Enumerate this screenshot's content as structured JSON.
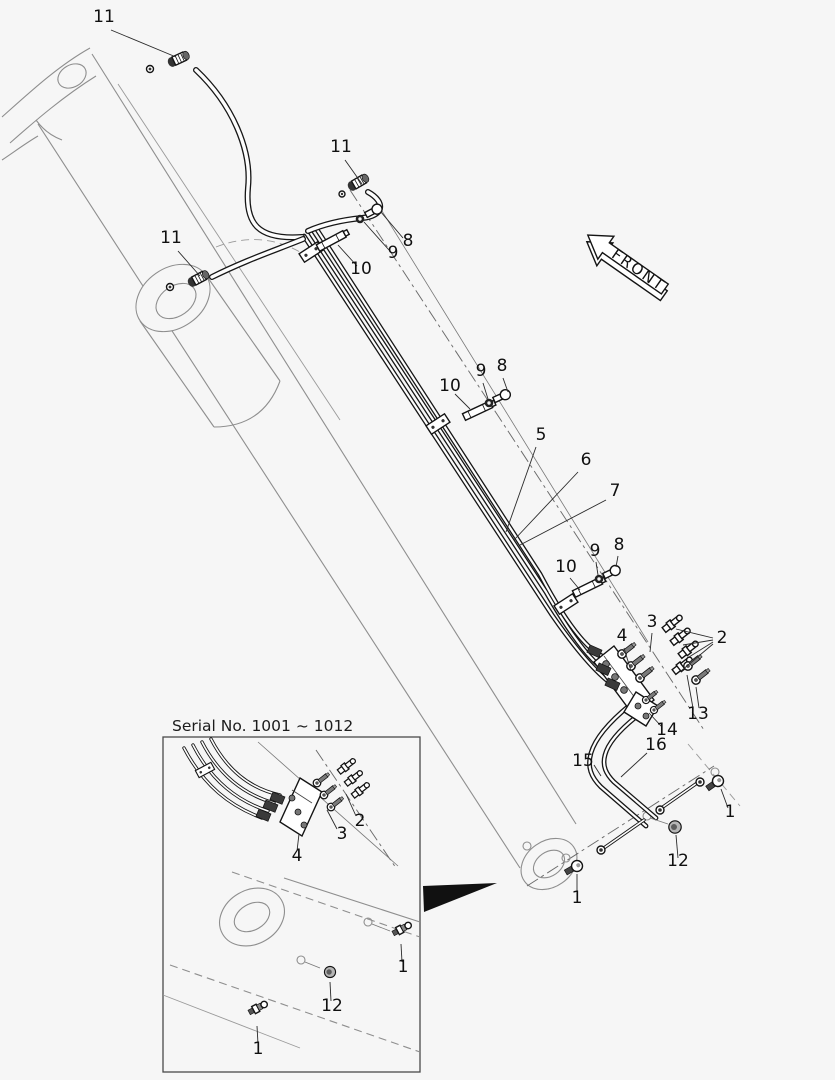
{
  "diagram_kind": "exploded-parts-piping-diagram",
  "colors": {
    "background": "#f6f6f6",
    "line": "#161616",
    "structure": "#8e8e8e",
    "callout_text": "#101010"
  },
  "front_arrow": {
    "label": "FRONT"
  },
  "inset": {
    "title": "Serial No. 1001 ~ 1012"
  },
  "callouts": [
    {
      "view": "main",
      "label": "11",
      "x": 104,
      "y": 22,
      "leaders": [
        [
          111,
          30,
          176,
          57
        ]
      ]
    },
    {
      "view": "main",
      "label": "11",
      "x": 341,
      "y": 152,
      "leaders": [
        [
          345,
          160,
          362,
          184
        ]
      ]
    },
    {
      "view": "main",
      "label": "11",
      "x": 171,
      "y": 243,
      "leaders": [
        [
          178,
          251,
          200,
          276
        ]
      ]
    },
    {
      "view": "main",
      "label": "8",
      "x": 408,
      "y": 246,
      "leaders": [
        [
          403,
          238,
          381,
          212
        ]
      ]
    },
    {
      "view": "main",
      "label": "9",
      "x": 393,
      "y": 258,
      "leaders": [
        [
          389,
          250,
          364,
          222
        ]
      ]
    },
    {
      "view": "main",
      "label": "10",
      "x": 361,
      "y": 274,
      "leaders": [
        [
          357,
          266,
          338,
          245
        ]
      ]
    },
    {
      "view": "main",
      "label": "10",
      "x": 450,
      "y": 391,
      "leaders": [
        [
          455,
          394,
          470,
          409
        ]
      ]
    },
    {
      "view": "main",
      "label": "9",
      "x": 481,
      "y": 376,
      "leaders": [
        [
          483,
          383,
          488,
          399
        ]
      ]
    },
    {
      "view": "main",
      "label": "8",
      "x": 502,
      "y": 371,
      "leaders": [
        [
          503,
          378,
          508,
          392
        ]
      ]
    },
    {
      "view": "main",
      "label": "5",
      "x": 541,
      "y": 440,
      "leaders": [
        [
          536,
          447,
          506,
          532
        ]
      ]
    },
    {
      "view": "main",
      "label": "6",
      "x": 586,
      "y": 465,
      "leaders": [
        [
          578,
          472,
          514,
          540
        ]
      ]
    },
    {
      "view": "main",
      "label": "7",
      "x": 615,
      "y": 496,
      "leaders": [
        [
          606,
          500,
          520,
          545
        ]
      ]
    },
    {
      "view": "main",
      "label": "10",
      "x": 566,
      "y": 572,
      "leaders": [
        [
          570,
          578,
          580,
          590
        ]
      ]
    },
    {
      "view": "main",
      "label": "9",
      "x": 595,
      "y": 556,
      "leaders": [
        [
          596,
          562,
          598,
          575
        ]
      ]
    },
    {
      "view": "main",
      "label": "8",
      "x": 619,
      "y": 550,
      "leaders": [
        [
          618,
          556,
          616,
          567
        ]
      ]
    },
    {
      "view": "main",
      "label": "4",
      "x": 622,
      "y": 641,
      "leaders": [
        [
          624,
          648,
          631,
          671
        ]
      ]
    },
    {
      "view": "main",
      "label": "3",
      "x": 652,
      "y": 627,
      "leaders": [
        [
          652,
          633,
          650,
          652
        ]
      ]
    },
    {
      "view": "main",
      "label": "2",
      "x": 722,
      "y": 643,
      "leaders": [
        [
          713,
          638,
          676,
          629
        ],
        [
          713,
          640,
          683,
          645
        ],
        [
          713,
          642,
          689,
          657
        ],
        [
          713,
          644,
          681,
          671
        ]
      ]
    },
    {
      "view": "main",
      "label": "13",
      "x": 698,
      "y": 719,
      "leaders": [
        [
          693,
          708,
          687,
          675
        ],
        [
          699,
          708,
          696,
          687
        ]
      ]
    },
    {
      "view": "main",
      "label": "14",
      "x": 667,
      "y": 735,
      "leaders": [
        [
          662,
          727,
          649,
          713
        ]
      ]
    },
    {
      "view": "main",
      "label": "16",
      "x": 656,
      "y": 750,
      "leaders": [
        [
          647,
          753,
          621,
          777
        ]
      ]
    },
    {
      "view": "main",
      "label": "15",
      "x": 583,
      "y": 766,
      "leaders": [
        [
          594,
          765,
          601,
          776
        ]
      ]
    },
    {
      "view": "main",
      "label": "1",
      "x": 730,
      "y": 817,
      "leaders": [
        [
          728,
          808,
          721,
          789
        ]
      ]
    },
    {
      "view": "main",
      "label": "12",
      "x": 678,
      "y": 866,
      "leaders": [
        [
          678,
          858,
          676,
          835
        ]
      ]
    },
    {
      "view": "main",
      "label": "1",
      "x": 577,
      "y": 903,
      "leaders": [
        [
          577,
          895,
          577,
          874
        ]
      ]
    },
    {
      "view": "inset",
      "label": "2",
      "x": 360,
      "y": 826,
      "leaders": [
        [
          356,
          816,
          346,
          794
        ]
      ]
    },
    {
      "view": "inset",
      "label": "3",
      "x": 342,
      "y": 839,
      "leaders": [
        [
          337,
          829,
          327,
          810
        ]
      ]
    },
    {
      "view": "inset",
      "label": "4",
      "x": 297,
      "y": 861,
      "leaders": [
        [
          297,
          851,
          299,
          834
        ]
      ]
    },
    {
      "view": "inset",
      "label": "1",
      "x": 403,
      "y": 972,
      "leaders": [
        [
          402,
          962,
          401,
          944
        ]
      ]
    },
    {
      "view": "inset",
      "label": "12",
      "x": 332,
      "y": 1011,
      "leaders": [
        [
          331,
          1001,
          330,
          982
        ]
      ]
    },
    {
      "view": "inset",
      "label": "1",
      "x": 258,
      "y": 1054,
      "leaders": [
        [
          258,
          1044,
          257,
          1026
        ]
      ]
    }
  ]
}
